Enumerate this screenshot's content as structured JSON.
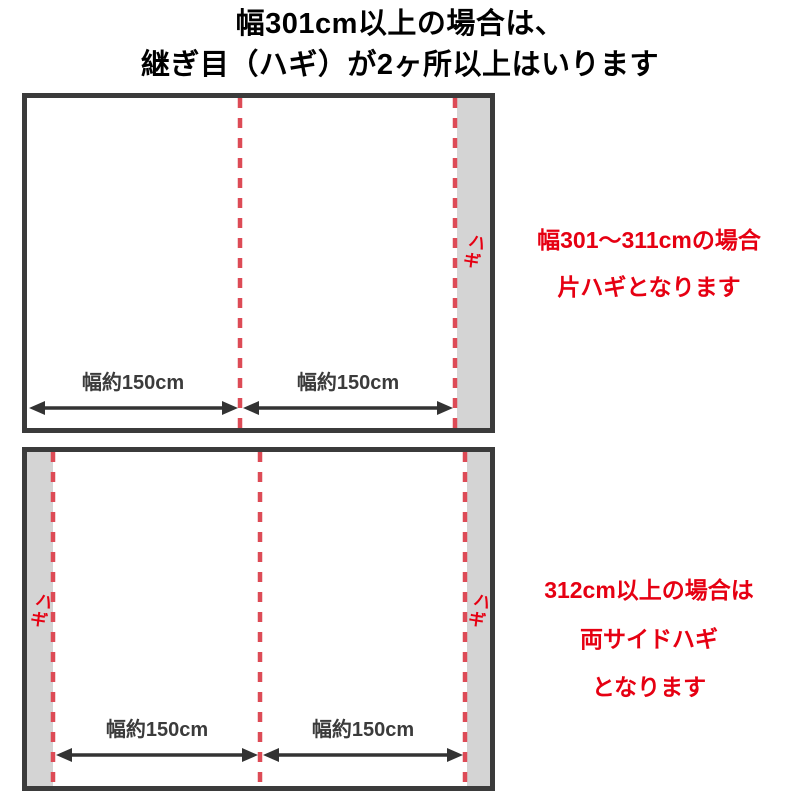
{
  "title": {
    "line1": "幅301cm以上の場合は、",
    "line2": "継ぎ目（ハギ）が2ヶ所以上はいります"
  },
  "diagram1": {
    "hagi": "ハギ",
    "width_left": "幅約150cm",
    "width_right": "幅約150cm",
    "caption1": "幅301〜311cmの場合",
    "caption2": "片ハギとなります"
  },
  "diagram2": {
    "hagi_left": "ハギ",
    "hagi_right": "ハギ",
    "width_left": "幅約150cm",
    "width_right": "幅約150cm",
    "caption1": "312cm以上の場合は",
    "caption2": "両サイドハギ",
    "caption3": "となります"
  },
  "colors": {
    "accent_red_text": "#e60012",
    "dash_red": "#dd4b56",
    "panel_gray": "#d4d4d4",
    "border_dark": "#3b3b3b",
    "arrow_dark": "#333333"
  }
}
